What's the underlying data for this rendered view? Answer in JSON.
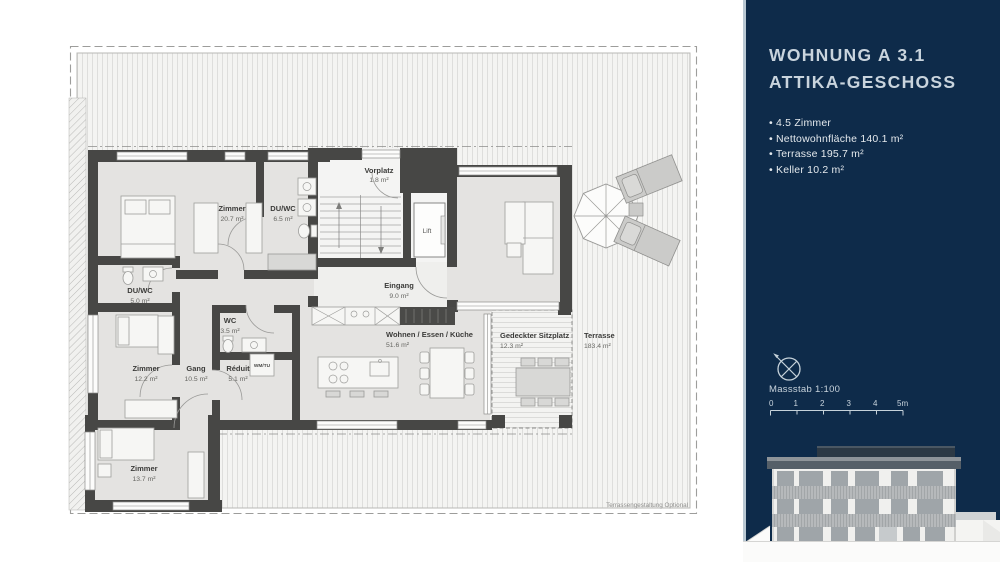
{
  "page": {
    "background": "#ffffff"
  },
  "sidebar": {
    "colors": {
      "background": "#0e2b4a",
      "edge_line": "#b9c8d3",
      "title_text": "#c9d4dd",
      "bullet_text": "#e4e9ed"
    },
    "title_line1": "WOHNUNG A 3.1",
    "title_line2": "ATTIKA-GESCHOSS",
    "bullets": [
      "4.5 Zimmer",
      "Nettowohnfläche 140.1 m²",
      "Terrasse 195.7 m²",
      "Keller 10.2 m²"
    ],
    "scale": {
      "label": "Massstab 1:100",
      "ticks": [
        "0",
        "1",
        "2",
        "3",
        "4",
        "5m"
      ]
    }
  },
  "floorplan": {
    "colors": {
      "wall": "#474745",
      "floor": "#e4e3e1",
      "terrace": "#f4f4f2"
    },
    "rooms": [
      {
        "name": "Zimmer",
        "area": "20.7 m²"
      },
      {
        "name": "DU/WC",
        "area": "6.5 m²"
      },
      {
        "name": "Vorplatz",
        "area": "1.8 m²"
      },
      {
        "name": "Eingang",
        "area": "9.0 m²"
      },
      {
        "name": "DU/WC",
        "area": "5.0 m²"
      },
      {
        "name": "WC",
        "area": "3.5 m²"
      },
      {
        "name": "Zimmer",
        "area": "12.2 m²"
      },
      {
        "name": "Gang",
        "area": "10.5 m²"
      },
      {
        "name": "Réduit",
        "area": "5.1 m²"
      },
      {
        "name": "Wohnen / Essen / Küche",
        "area": "51.6 m²"
      },
      {
        "name": "Gedeckter Sitzplatz",
        "area": "12.3 m²"
      },
      {
        "name": "Terrasse",
        "area": "183.4 m²"
      },
      {
        "name": "Zimmer",
        "area": "13.7 m²"
      }
    ],
    "lift_label": "Lift",
    "wm_label": "WM/TU",
    "note": "Terrassengestaltung Optional"
  }
}
